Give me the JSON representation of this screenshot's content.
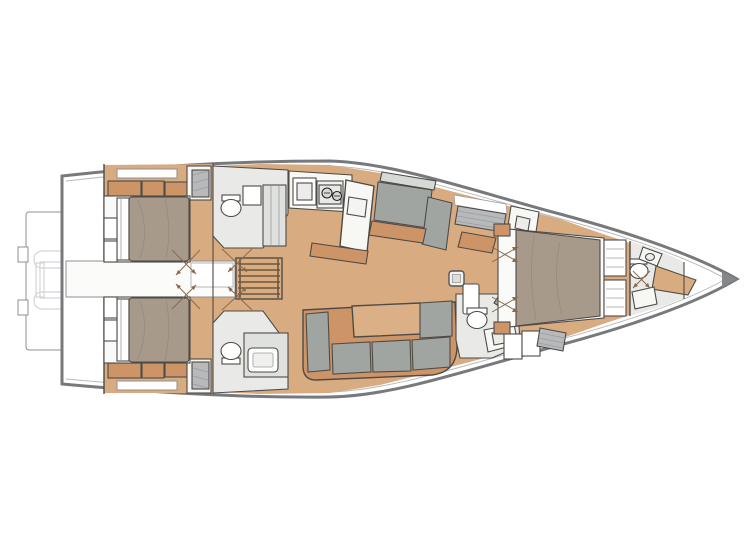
{
  "meta": {
    "title": "Sailing yacht interior layout plan (deck plan, bow to the right)",
    "type": "floor-plan"
  },
  "palette": {
    "hull-outline": "#77797c",
    "inner-line": "#b9bbbd",
    "floor-wood": "#d9ab81",
    "wood-dark": "#cd9468",
    "furniture-white": "#f7f7f4",
    "panel-light": "#e9eae7",
    "bed-taupe": "#a79a8b",
    "cushion-gray": "#a0a5a2",
    "hatch-gray": "#b7babb",
    "line-dark": "#4e4b47",
    "sketch-faint": "#d4d5d6",
    "door-line": "#8a6b4f",
    "bow-tip": "#85878a"
  },
  "areas": {
    "stern": [
      "swim-platform",
      "tender-sketch",
      "tender-garage"
    ],
    "aft": [
      "aft-cabin-starboard",
      "aft-cabin-port",
      "head-starboard-aft",
      "head-port-aft",
      "companionway-stairs",
      "engine-hatch"
    ],
    "salon": [
      "galley",
      "galley-sink",
      "stove-two-burners",
      "island-counter",
      "settee-starboard",
      "sofa-port",
      "saloon-table",
      "mast-post"
    ],
    "forward": [
      "head-port-mid",
      "owner-cabin",
      "island-bed",
      "vanity-starboard",
      "vanity-port",
      "head-forward",
      "anchor-locker"
    ]
  }
}
